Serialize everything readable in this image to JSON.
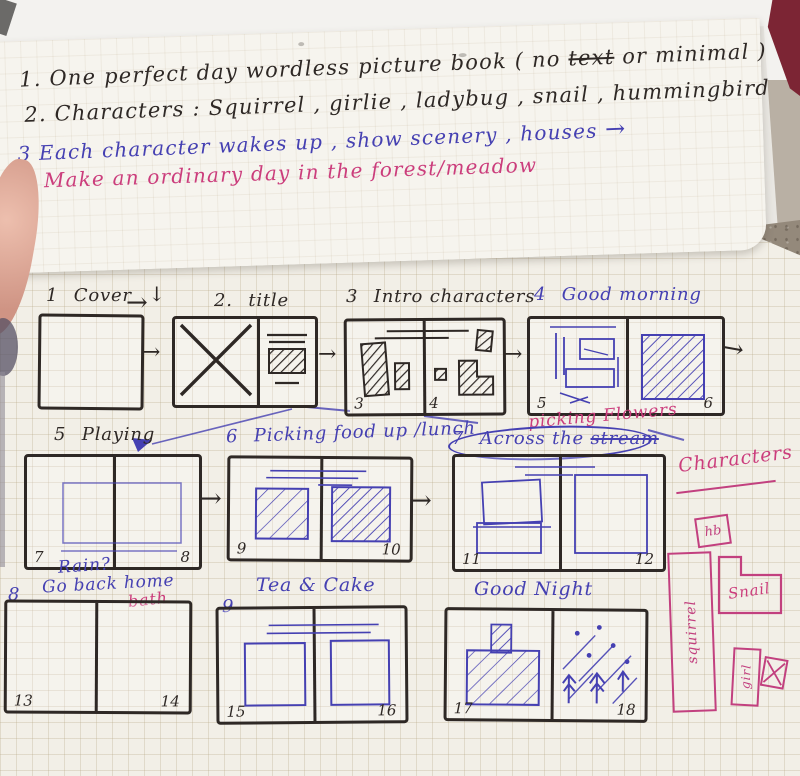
{
  "colors": {
    "ink_black": "#2e2825",
    "ink_blue": "#4540b2",
    "ink_pink": "#cb3d7c",
    "paper": "#f2efe7",
    "table": "#94897b"
  },
  "glyphs": {
    "arrow_right": "→",
    "arrow_down": "↓"
  },
  "notes": {
    "l1n": "1.",
    "l1a": "One perfect day wordless picture book ( no ",
    "l1strike": "text",
    "l1b": " or minimal )",
    "l2": "2. Characters : Squirrel , girlie , ladybug , snail , hummingbird",
    "l3": "3 Each character wakes up , show scenery , houses",
    "l4": "4 Make an ordinary day in the forest/meadow"
  },
  "frames": {
    "f1": {
      "num": "1",
      "title": "Cover"
    },
    "f2": {
      "num": "2.",
      "title": "title"
    },
    "f3": {
      "num": "3",
      "title": "Intro characters",
      "pl": "3",
      "pr": "4"
    },
    "f4": {
      "num": "4",
      "title": "Good morning",
      "pl": "5",
      "pr": "6"
    },
    "f5": {
      "num": "5",
      "title": "Playing",
      "pl": "7",
      "pr": "8"
    },
    "f6": {
      "num": "6",
      "title": "Picking food up /lunch",
      "pl": "9",
      "pr": "10"
    },
    "f7": {
      "num": "7",
      "title_pre": "Across the ",
      "title_struck": "stream",
      "note_pink": "picking Flowers",
      "pl": "11",
      "pr": "12"
    },
    "f8": {
      "num": "8",
      "note1": "Rain?",
      "note2": "Go back home",
      "note_pink": "bath",
      "pl": "13",
      "pr": "14"
    },
    "f9": {
      "num": "9",
      "title": "Tea & Cake",
      "pl": "15",
      "pr": "16"
    },
    "f10": {
      "title": "Good Night",
      "pl": "17",
      "pr": "18"
    }
  },
  "characters": {
    "heading": "Characters",
    "hummingbird": "hb",
    "snail": "Snail",
    "squirrel": "squirrel",
    "girl": "girl"
  }
}
